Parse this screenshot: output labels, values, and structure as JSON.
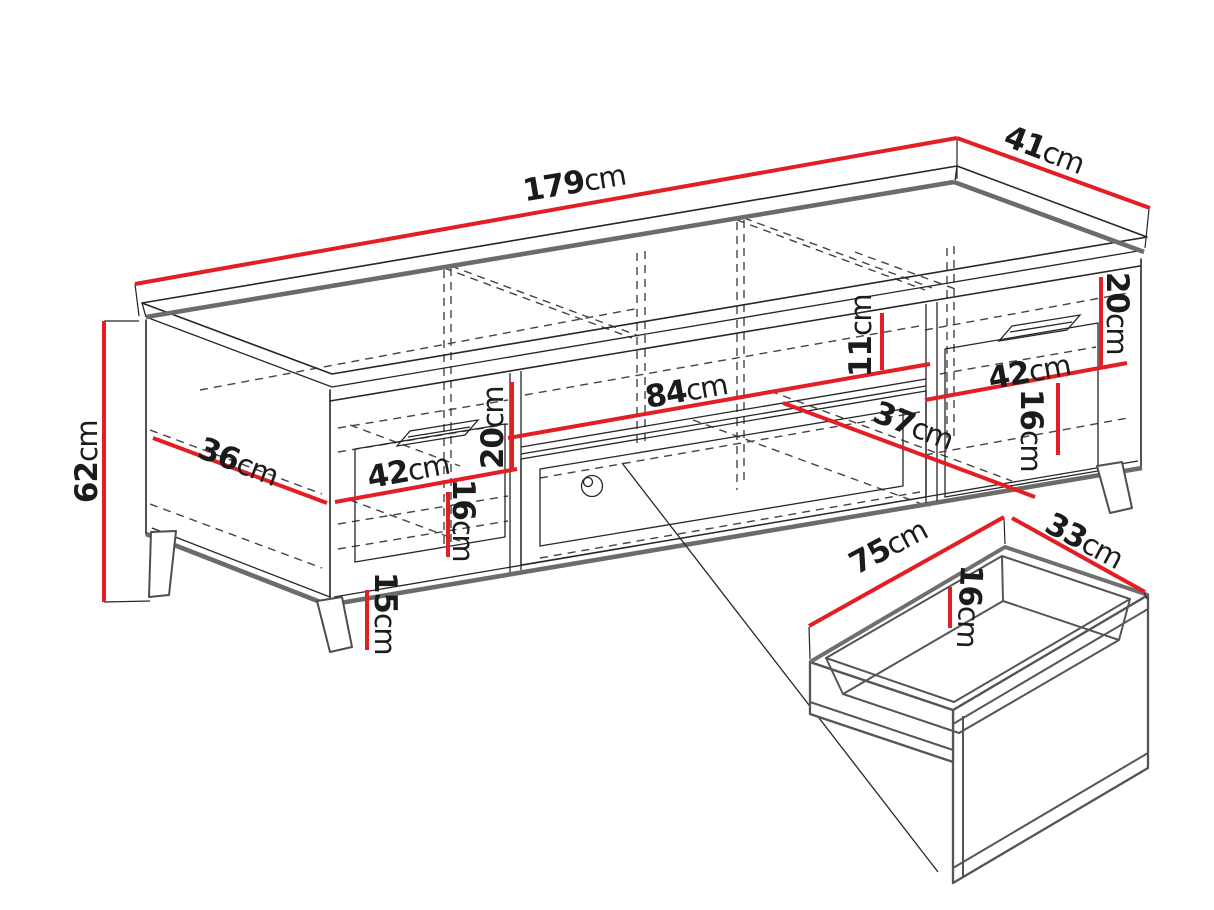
{
  "figure": {
    "type": "furniture-dimension-diagram",
    "subject": "TV cabinet with two drawers, middle niche and detached drawer box"
  },
  "colors": {
    "dimension_red": "#e31e24",
    "outline_dark": "#262626",
    "edge_gray": "#6b6b6b",
    "background": "#ffffff"
  },
  "dims": {
    "width_total": {
      "value": "179",
      "unit": "cm"
    },
    "depth_total": {
      "value": "41",
      "unit": "cm"
    },
    "height_total": {
      "value": "62",
      "unit": "cm"
    },
    "side_inner_depth": {
      "value": "36",
      "unit": "cm"
    },
    "left_drawer_width": {
      "value": "42",
      "unit": "cm"
    },
    "left_opening_height": {
      "value": "20",
      "unit": "cm"
    },
    "left_drawer_height": {
      "value": "16",
      "unit": "cm"
    },
    "leg_height": {
      "value": "15",
      "unit": "cm"
    },
    "middle_niche_width": {
      "value": "84",
      "unit": "cm"
    },
    "middle_niche_height": {
      "value": "11",
      "unit": "cm"
    },
    "middle_inner_depth": {
      "value": "37",
      "unit": "cm"
    },
    "right_opening_height": {
      "value": "20",
      "unit": "cm"
    },
    "right_drawer_width": {
      "value": "42",
      "unit": "cm"
    },
    "right_drawer_height": {
      "value": "16",
      "unit": "cm"
    },
    "drawer_box_width": {
      "value": "75",
      "unit": "cm"
    },
    "drawer_box_depth": {
      "value": "33",
      "unit": "cm"
    },
    "drawer_box_height": {
      "value": "16",
      "unit": "cm"
    }
  }
}
